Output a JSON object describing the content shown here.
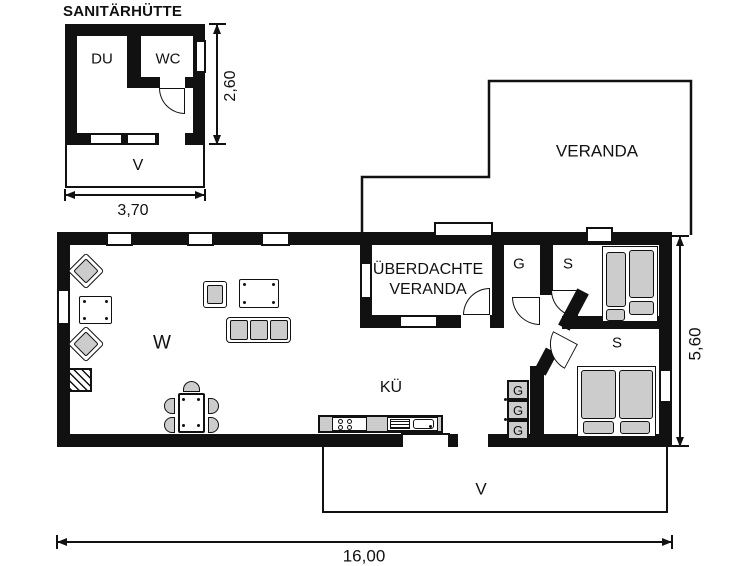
{
  "hut": {
    "title": "SANITÄRHÜTTE",
    "rooms": {
      "du": "DU",
      "wc": "WC",
      "veranda": "V"
    },
    "dims": {
      "width": "3,70",
      "depth": "2,60"
    }
  },
  "main": {
    "rooms": {
      "w": "W",
      "ku": "KÜ",
      "covered_veranda_line1": "ÜBERDACHTE",
      "covered_veranda_line2": "VERANDA",
      "g": "G",
      "s1": "S",
      "s2": "S",
      "v": "V",
      "veranda_open": "VERANDA"
    },
    "closets": [
      "G",
      "G",
      "G"
    ],
    "dims": {
      "width": "16,00",
      "depth": "5,60"
    }
  },
  "colors": {
    "wall": "#111111",
    "furniture": "#cccccc",
    "background": "#ffffff"
  }
}
